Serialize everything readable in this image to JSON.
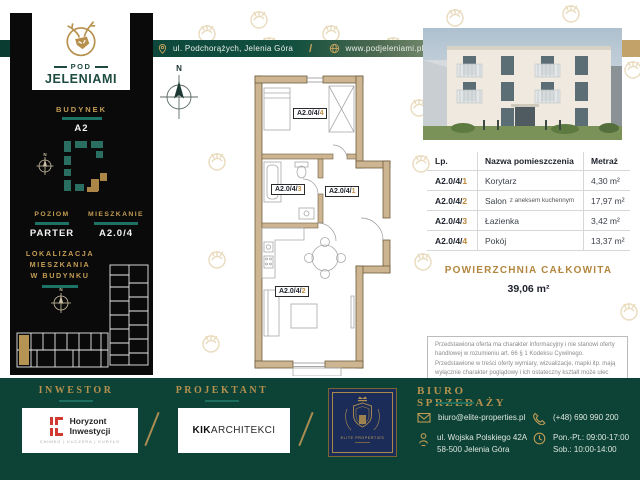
{
  "brand": {
    "pod": "POD",
    "name": "JELENIAMI"
  },
  "header": {
    "address": "ul. Podchorążych, Jelenia Góra",
    "separator": "/",
    "website": "www.podjeleniami.pl"
  },
  "sidebar": {
    "budynek_label": "BUDYNEK",
    "budynek_value": "A2",
    "poziom_label": "POZIOM",
    "poziom_value": "PARTER",
    "mieszkanie_label": "MIESZKANIE",
    "mieszkanie_value": "A2.0/4",
    "lokalizacja_heading": "LOKALIZACJA\nMIESZKANIA\nW BUDYNKU",
    "compass_n": "N"
  },
  "floorplan": {
    "compass_n": "N",
    "labels": [
      {
        "prefix": "A2.0/4/",
        "num": "4"
      },
      {
        "prefix": "A2.0/4/",
        "num": "3"
      },
      {
        "prefix": "A2.0/4/",
        "num": "1"
      },
      {
        "prefix": "A2.0/4/",
        "num": "2"
      }
    ]
  },
  "table": {
    "headers": [
      "Lp.",
      "Nazwa pomieszczenia",
      "Metraż"
    ],
    "rows": [
      {
        "lp_prefix": "A2.0/4/",
        "lp_num": "1",
        "name": "Korytarz",
        "name_small": "",
        "area": "4,30 m²"
      },
      {
        "lp_prefix": "A2.0/4/",
        "lp_num": "2",
        "name": "Salon",
        "name_small": "z aneksem kuchennym",
        "area": "17,97 m²"
      },
      {
        "lp_prefix": "A2.0/4/",
        "lp_num": "3",
        "name": "Łazienka",
        "name_small": "",
        "area": "3,42 m²"
      },
      {
        "lp_prefix": "A2.0/4/",
        "lp_num": "4",
        "name": "Pokój",
        "name_small": "",
        "area": "13,37 m²"
      }
    ]
  },
  "summary": {
    "label": "POWIERZCHNIA CAŁKOWITA",
    "value": "39,06 m²"
  },
  "disclaimer": "Przedstawiona oferta ma charakter informacyjny i nie stanowi oferty handlowej w rozumieniu art. 66 § 1 Kodeksu Cywilnego. Przedstawione w treści oferty wymiary, wizualizacje, mapki itp. mają wyłącznie charakter poglądowy i ich ostateczny kształt może ulec zmianie.",
  "footer": {
    "inwestor_heading": "INWESTOR",
    "inwestor_logo": {
      "line1": "Horyzont",
      "line2": "Inwestycji",
      "sub": "CHIMKO | KUCZERA | KURYŁO"
    },
    "projektant_heading": "PROJEKTANT",
    "projektant_logo": {
      "bold": "KIK",
      "rest": "ARCHITEKCI"
    },
    "elite_logo_text": "ELITE PROPERTIES",
    "biuro_heading": "BIURO SPRZEDAŻY",
    "email": "biuro@elite-properties.pl",
    "phone": "(+48) 690 990 200",
    "address_line1": "ul. Wojska Polskiego 42A",
    "address_line2": "58-500 Jelenia Góra",
    "hours_line1": "Pon.-Pt.: 09:00-17:00",
    "hours_line2": "Sob.: 10:00-14:00"
  },
  "colors": {
    "teal": "#0d4237",
    "teal_accent": "#1c7265",
    "gold": "#b7924e",
    "black": "#0a0a0a"
  }
}
